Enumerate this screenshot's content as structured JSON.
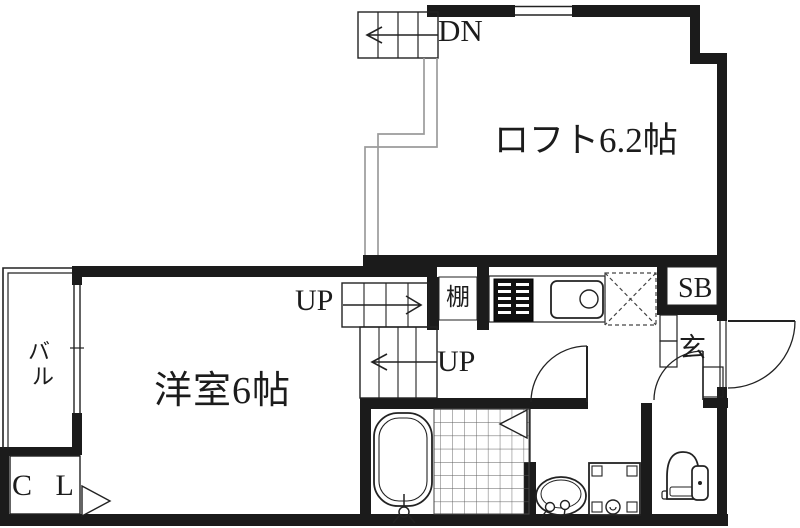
{
  "plan": {
    "loft_label": "ロフト6.2帖",
    "dn_label": "DN",
    "up_label_upper": "UP",
    "up_label_lower": "UP",
    "shelf_label": "棚",
    "shoe_box_label": "SB",
    "entrance_label": "玄",
    "balcony_label_char1": "バ",
    "balcony_label_char2": "ル",
    "room_label": "洋室6帖",
    "closet_label": "C L"
  },
  "colors": {
    "background": "#ffffff",
    "wall": "#1b1b1b",
    "line": "#222222",
    "void_line": "#9b9b9b",
    "tile_line": "#5a5a5a"
  }
}
